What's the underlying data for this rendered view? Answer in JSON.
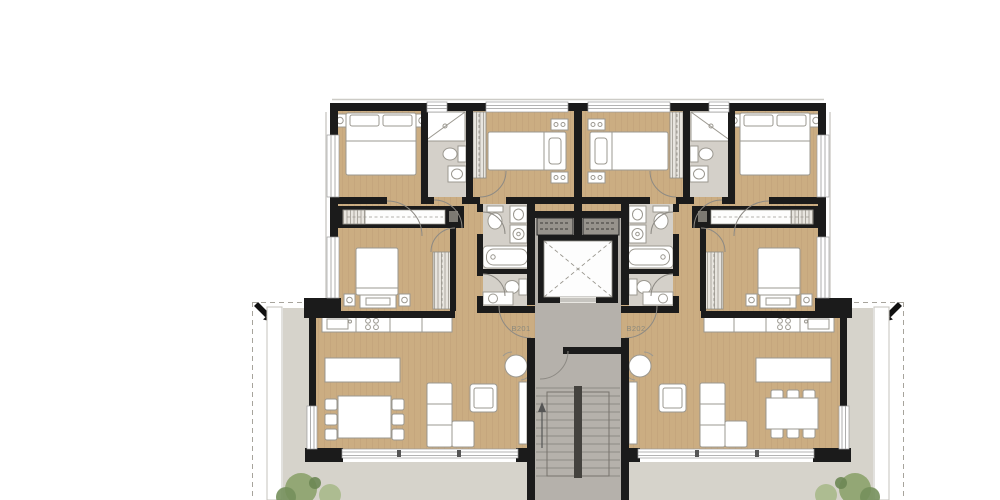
{
  "plan": {
    "unit_labels": [
      "B201",
      "B202"
    ],
    "colors": {
      "background": "#ffffff",
      "wall": "#1b1b1b",
      "wood_floor": "#cbad82",
      "wood_plank_line": "#bfa077",
      "bath_floor": "#d4d0c9",
      "terrace": "#d6d3cb",
      "core_floor": "#b5b1ab",
      "stair_tread_line": "#8d8a84",
      "furniture_fill": "#ffffff",
      "furniture_stroke": "#9b9890",
      "door_arc": "#8d8a84",
      "label_text": "#8b897d",
      "plant_green": "#8fa470"
    }
  }
}
